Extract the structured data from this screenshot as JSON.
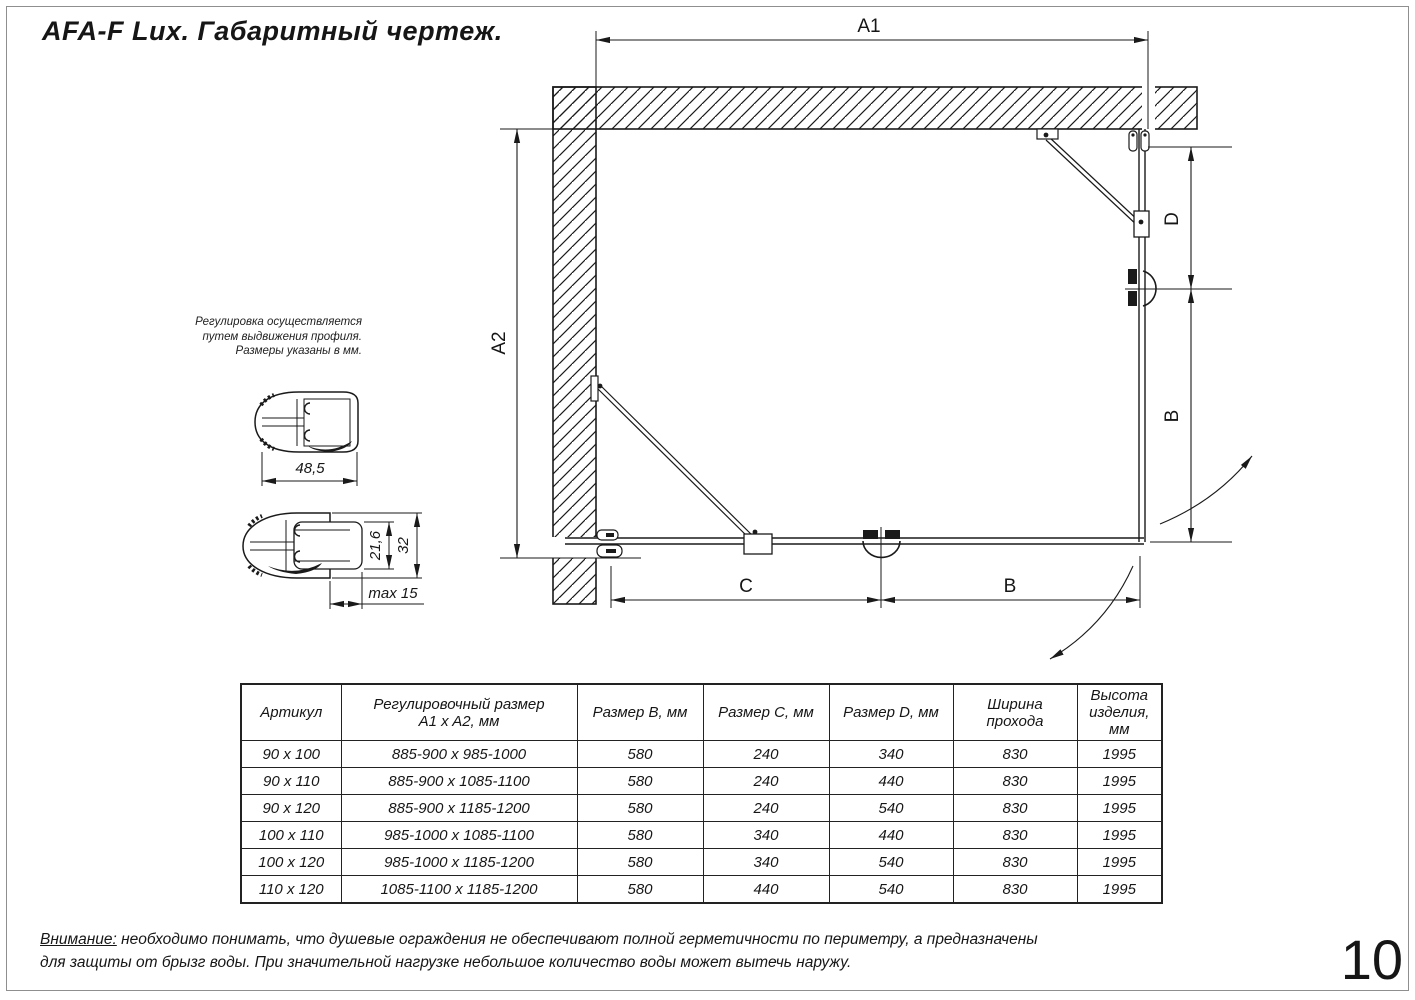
{
  "page": {
    "title": "AFA-F Lux. Габаритный чертеж.",
    "page_number": "10",
    "warning_label": "Внимание:",
    "warning_line1": " необходимо понимать, что душевые ограждения не обеспечивают полной герметичности по периметру, а предназначены",
    "warning_line2": "для защиты от брызг воды. При значительной нагрузке небольшое количество воды может вытечь наружу."
  },
  "note": {
    "line1": "Регулировка осуществляется",
    "line2": "путем выдвижения профиля.",
    "line3": "Размеры указаны в мм."
  },
  "drawing": {
    "dim_a1": "A1",
    "dim_a2": "A2",
    "dim_d": "D",
    "dim_b_right": "B",
    "dim_c": "C",
    "dim_b_bottom": "B"
  },
  "profiles": {
    "dim_width": "48,5",
    "dim_inner": "21,6",
    "dim_outer": "32",
    "dim_max": "max 15"
  },
  "table": {
    "headers": [
      "Артикул",
      "Регулировочный размер\nA1 x A2, мм",
      "Размер B, мм",
      "Размер C, мм",
      "Размер D, мм",
      "Ширина\nпрохода",
      "Высота\nизделия,\nмм"
    ],
    "rows": [
      [
        "90 x 100",
        "885-900 x 985-1000",
        "580",
        "240",
        "340",
        "830",
        "1995"
      ],
      [
        "90 x 110",
        "885-900 x 1085-1100",
        "580",
        "240",
        "440",
        "830",
        "1995"
      ],
      [
        "90 x 120",
        "885-900 x 1185-1200",
        "580",
        "240",
        "540",
        "830",
        "1995"
      ],
      [
        "100 x 110",
        "985-1000 x 1085-1100",
        "580",
        "340",
        "440",
        "830",
        "1995"
      ],
      [
        "100 x 120",
        "985-1000 x 1185-1200",
        "580",
        "340",
        "540",
        "830",
        "1995"
      ],
      [
        "110 x 120",
        "1085-1100 x 1185-1200",
        "580",
        "440",
        "540",
        "830",
        "1995"
      ]
    ]
  },
  "colors": {
    "line": "#1a1a1a",
    "background": "#ffffff"
  }
}
